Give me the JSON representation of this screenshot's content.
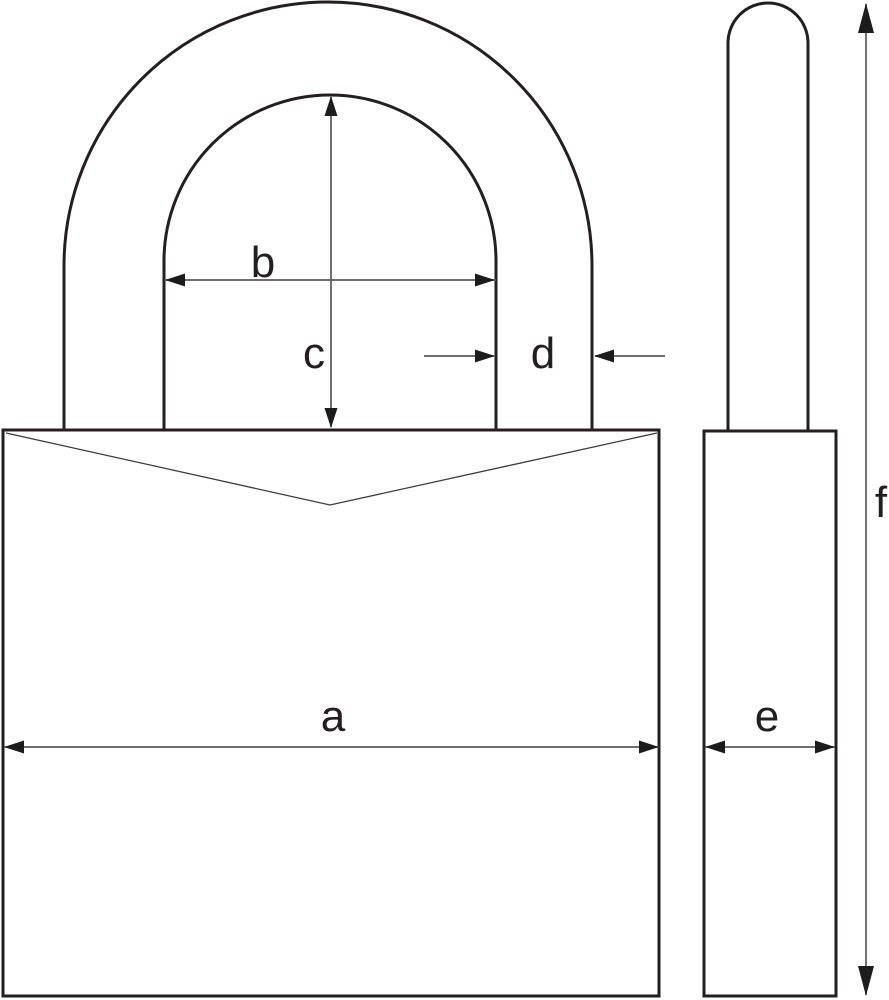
{
  "colors": {
    "background": "#ffffff",
    "outline": "#231f20",
    "thin_line": "#3c3c3c",
    "dimension_line": "#5a5a5a",
    "arrowhead": "#1c1c1c",
    "label": "#231f20"
  },
  "dimension_labels": {
    "a": "a",
    "b": "b",
    "c": "c",
    "d": "d",
    "e": "e",
    "f": "f"
  }
}
